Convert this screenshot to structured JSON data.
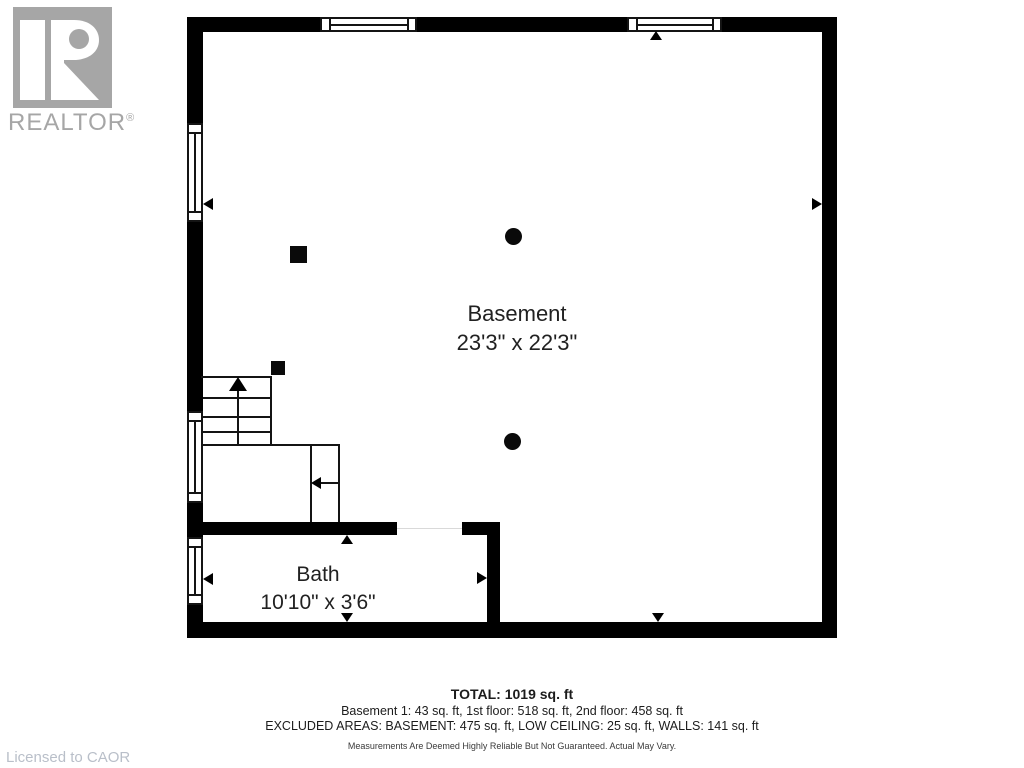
{
  "branding": {
    "logo_wordmark": "REALTOR",
    "registered_mark": "®",
    "license_text": "Licensed to CAOR"
  },
  "floorplan": {
    "rooms": [
      {
        "name": "Basement",
        "dimensions": "23'3\" x 22'3\""
      },
      {
        "name": "Bath",
        "dimensions": "10'10\" x 3'6\""
      }
    ],
    "features": {
      "stair_direction": "up",
      "top_windows": 2,
      "left_windows": 3,
      "round_posts": 2,
      "square_posts": 2
    }
  },
  "summary": {
    "total": "TOTAL: 1019 sq. ft",
    "floor_breakdown": "Basement 1: 43 sq. ft, 1st floor: 518 sq. ft, 2nd floor: 458 sq. ft",
    "excluded_areas": "EXCLUDED AREAS: BASEMENT: 475 sq. ft, LOW CEILING: 25 sq. ft, WALLS: 141 sq. ft",
    "disclaimer": "Measurements Are Deemed Highly Reliable But Not Guaranteed. Actual May Vary."
  },
  "colors": {
    "wall": "#000000",
    "text": "#212121",
    "logo_gray": "#a6a6a6",
    "license_gray": "#b9bfc9"
  }
}
